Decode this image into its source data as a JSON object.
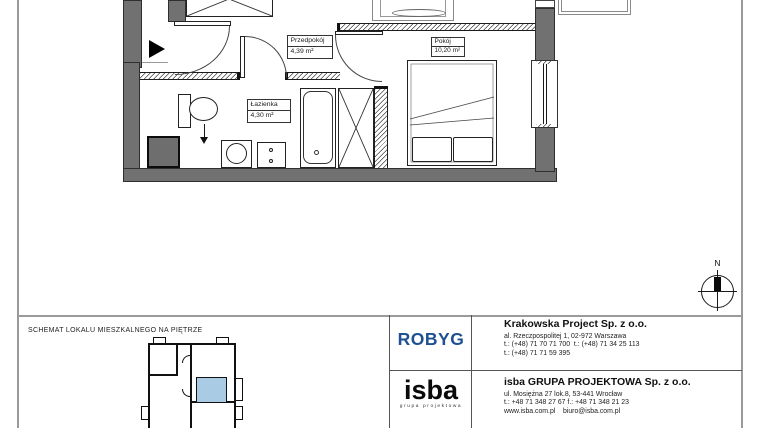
{
  "plan": {
    "compass": {
      "label": "N"
    },
    "rooms": [
      {
        "name": "Przedpokój",
        "area": "4,39 m²"
      },
      {
        "name": "Pokój",
        "area": "10,20 m²"
      },
      {
        "name": "Łazienka",
        "area": "4,30 m²"
      }
    ]
  },
  "title_block": {
    "schema_title": "SCHEMAT LOKALU MIESZKALNEGO NA PIĘTRZE",
    "developer": {
      "logo_text": "ROBYG",
      "company": "Krakowska Project Sp. z o.o.",
      "address": "al. Rzeczpospolitej 1, 02-972 Warszawa",
      "phones_line1": "t.: (+48) 71 70 71 700  t.: (+48) 71 34 25 113",
      "phones_line2": "t.: (+48) 71 71 59 395"
    },
    "studio": {
      "logo_text": "isba",
      "logo_subtext": "grupa projektowa",
      "company": "isba GRUPA PROJEKTOWA Sp. z o.o.",
      "address": "ul. Mosiężna 27 lok.8, 53-441 Wrocław",
      "phones_line": "t.: +48 71 348 27 67 f.: +48 71 348 21 23",
      "web_line": "www.isba.com.pl    biuro@isba.com.pl"
    }
  },
  "colors": {
    "wall_gray": "#717171",
    "highlight_blue": "#a9cbe4",
    "robyg_blue": "#1d5191"
  }
}
